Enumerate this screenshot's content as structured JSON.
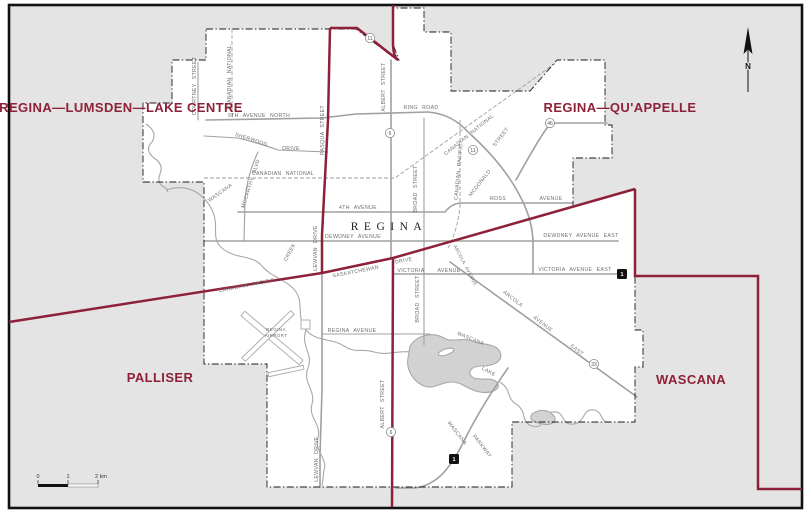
{
  "map": {
    "city_label": "REGINA",
    "colors": {
      "district_line": "#8e2139",
      "district_text": "#8e2139",
      "outside_fill": "#e4e4e4",
      "city_fill": "#ffffff",
      "road": "#a0a0a0",
      "water_fill": "#d2d2d2",
      "water_line": "#a8a8a8",
      "frame": "#111111"
    },
    "districts": [
      {
        "name": "REGINA—LUMSDEN—LAKE CENTRE",
        "x": 121,
        "y": 112
      },
      {
        "name": "REGINA—QU'APPELLE",
        "x": 620,
        "y": 112
      },
      {
        "name": "PALLISER",
        "x": 160,
        "y": 382
      },
      {
        "name": "WASCANA",
        "x": 691,
        "y": 384
      }
    ],
    "street_labels": [
      {
        "text": "COURTNEY STREET",
        "x": 196,
        "y": 86,
        "rot": -90
      },
      {
        "text": "CANADIAN NATIONAL",
        "x": 231,
        "y": 76,
        "rot": -90
      },
      {
        "text": "9TH AVENUE NORTH",
        "x": 259,
        "y": 117,
        "rot": 0
      },
      {
        "text": "SHERWOOD",
        "x": 251,
        "y": 141,
        "rot": 18
      },
      {
        "text": "DRIVE",
        "x": 291,
        "y": 150,
        "rot": 0
      },
      {
        "text": "PASQUA STREET",
        "x": 324,
        "y": 130,
        "rot": -90
      },
      {
        "text": "ALBERT STREET",
        "x": 385,
        "y": 87,
        "rot": -90
      },
      {
        "text": "RING ROAD",
        "x": 421,
        "y": 109,
        "rot": 0
      },
      {
        "text": "CANADIAN NATIONAL",
        "x": 283,
        "y": 175,
        "rot": 0
      },
      {
        "text": "MCCARTHY BLVD",
        "x": 252,
        "y": 184,
        "rot": -72
      },
      {
        "text": "WASCANA",
        "x": 221,
        "y": 194,
        "rot": -35
      },
      {
        "text": "CREEK",
        "x": 291,
        "y": 253,
        "rot": -62
      },
      {
        "text": "4TH AVENUE",
        "x": 358,
        "y": 209,
        "rot": 0
      },
      {
        "text": "DEWDNEY AVENUE",
        "x": 353,
        "y": 238,
        "rot": 0
      },
      {
        "text": "CANADIAN PACIFIC",
        "x": 460,
        "y": 172,
        "rot": -85
      },
      {
        "text": "MCDONALD",
        "x": 481,
        "y": 184,
        "rot": -52
      },
      {
        "text": "STREET",
        "x": 502,
        "y": 138,
        "rot": -52
      },
      {
        "text": "CANADIAN NATIONAL",
        "x": 470,
        "y": 136,
        "rot": -39
      },
      {
        "text": "ROSS",
        "x": 498,
        "y": 200,
        "rot": 0
      },
      {
        "text": "AVENUE",
        "x": 551,
        "y": 200,
        "rot": 0
      },
      {
        "text": "DEWDNEY AVENUE EAST",
        "x": 581,
        "y": 237,
        "rot": 0
      },
      {
        "text": "BROAD STREET",
        "x": 417,
        "y": 189,
        "rot": -90
      },
      {
        "text": "BROAD STREET",
        "x": 419,
        "y": 299,
        "rot": -90
      },
      {
        "text": "LEWVAN DRIVE",
        "x": 317,
        "y": 248,
        "rot": -90
      },
      {
        "text": "LEWVAN DRIVE",
        "x": 318,
        "y": 459,
        "rot": -90
      },
      {
        "text": "SASKATCHEWAN",
        "x": 356,
        "y": 273,
        "rot": -11
      },
      {
        "text": "DRIVE",
        "x": 404,
        "y": 262,
        "rot": -11
      },
      {
        "text": "CANADIAN PACIFIC",
        "x": 247,
        "y": 287,
        "rot": -11
      },
      {
        "text": "VICTORIA",
        "x": 411,
        "y": 272,
        "rot": 0
      },
      {
        "text": "AVENUE",
        "x": 449,
        "y": 272,
        "rot": 0
      },
      {
        "text": "VICTORIA AVENUE EAST",
        "x": 575,
        "y": 271,
        "rot": 0
      },
      {
        "text": "ARCOLA AVENUE",
        "x": 464,
        "y": 266,
        "rot": 62,
        "cls": "tiny"
      },
      {
        "text": "ARCOLA",
        "x": 512,
        "y": 300,
        "rot": 38
      },
      {
        "text": "AVENUE",
        "x": 542,
        "y": 325,
        "rot": 38
      },
      {
        "text": "EAST",
        "x": 576,
        "y": 351,
        "rot": 38
      },
      {
        "text": "REGINA AVENUE",
        "x": 352,
        "y": 332,
        "rot": 0
      },
      {
        "text": "REGINA",
        "x": 276,
        "y": 331,
        "rot": 0,
        "cls": "tiny"
      },
      {
        "text": "AIRPORT",
        "x": 276,
        "y": 337,
        "rot": 0,
        "cls": "tiny"
      },
      {
        "text": "WASCANA",
        "x": 470,
        "y": 340,
        "rot": 22
      },
      {
        "text": "LAKE",
        "x": 488,
        "y": 373,
        "rot": 28
      },
      {
        "text": "WASCANA",
        "x": 456,
        "y": 434,
        "rot": 52
      },
      {
        "text": "PARKWAY",
        "x": 481,
        "y": 447,
        "rot": 52
      },
      {
        "text": "ALBERT STREET",
        "x": 384,
        "y": 404,
        "rot": -90
      }
    ],
    "shields": [
      {
        "type": "circle",
        "num": "11",
        "x": 370,
        "y": 38
      },
      {
        "type": "circle",
        "num": "6",
        "x": 390,
        "y": 133
      },
      {
        "type": "circle",
        "num": "11",
        "x": 473,
        "y": 150
      },
      {
        "type": "circle",
        "num": "46",
        "x": 550,
        "y": 123
      },
      {
        "type": "circle",
        "num": "33",
        "x": 594,
        "y": 364
      },
      {
        "type": "circle",
        "num": "6",
        "x": 391,
        "y": 432
      },
      {
        "type": "tch",
        "num": "1",
        "x": 622,
        "y": 274
      },
      {
        "type": "tch",
        "num": "1",
        "x": 454,
        "y": 459
      }
    ],
    "north_arrow": {
      "label": "N"
    },
    "scale_bar": {
      "tick0": "0",
      "tick1": "1",
      "tick2": "2 km"
    }
  }
}
